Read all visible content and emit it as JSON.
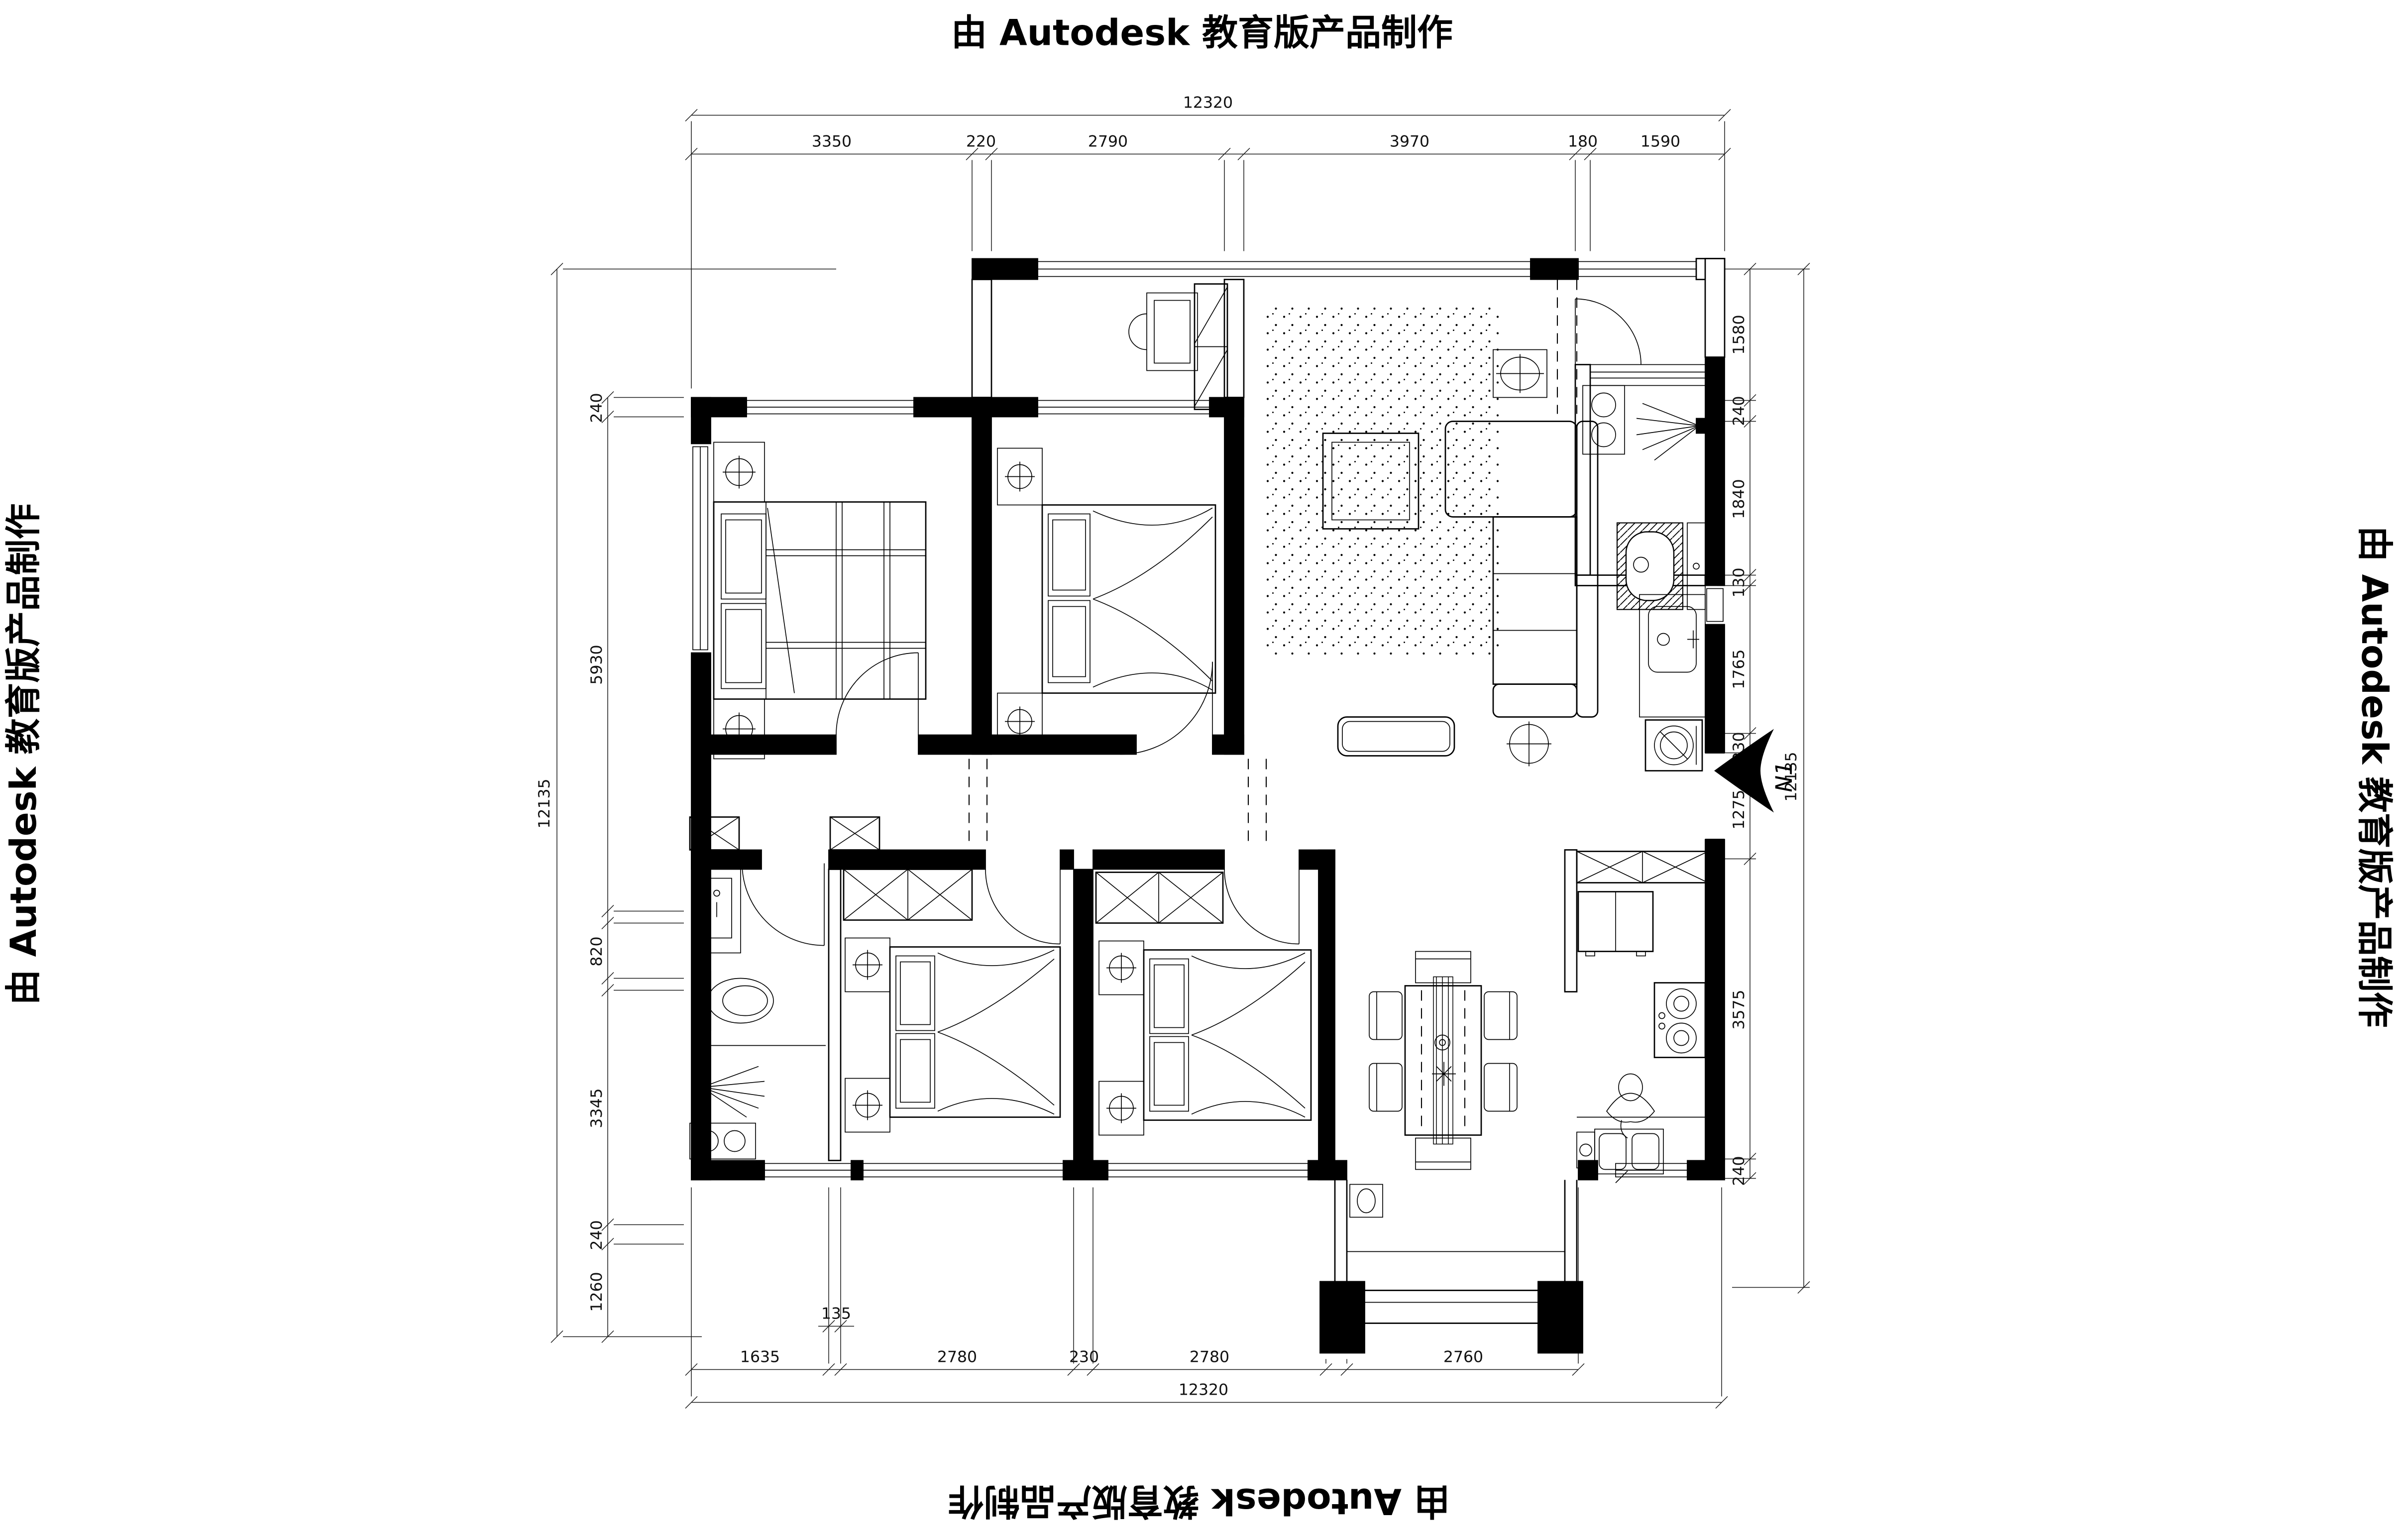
{
  "titles": {
    "top": "由 Autodesk 教育版产品制作",
    "bottom": "由 Autodesk 教育版产品制作",
    "left": "由 Autodesk 教育版产品制作",
    "right": "由 Autodesk 教育版产品制作"
  },
  "north": {
    "label": "N1"
  },
  "dims": {
    "top": {
      "total": "12320",
      "segments": [
        "3350",
        "220",
        "2790",
        "3970",
        "180",
        "1590"
      ]
    },
    "bottom": {
      "total": "12320",
      "segments": [
        "1635",
        "135",
        "2780",
        "230",
        "2780",
        "2760"
      ]
    },
    "left": {
      "total": "12135",
      "segments": [
        "240",
        "5930",
        "820",
        "3345",
        "240",
        "1260"
      ]
    },
    "right": {
      "total": "12135",
      "segments": [
        "1580",
        "240",
        "1840",
        "130",
        "1765",
        "230",
        "1275",
        "3575",
        "240"
      ]
    }
  },
  "colors": {
    "ink": "#000000",
    "paper": "#ffffff"
  }
}
